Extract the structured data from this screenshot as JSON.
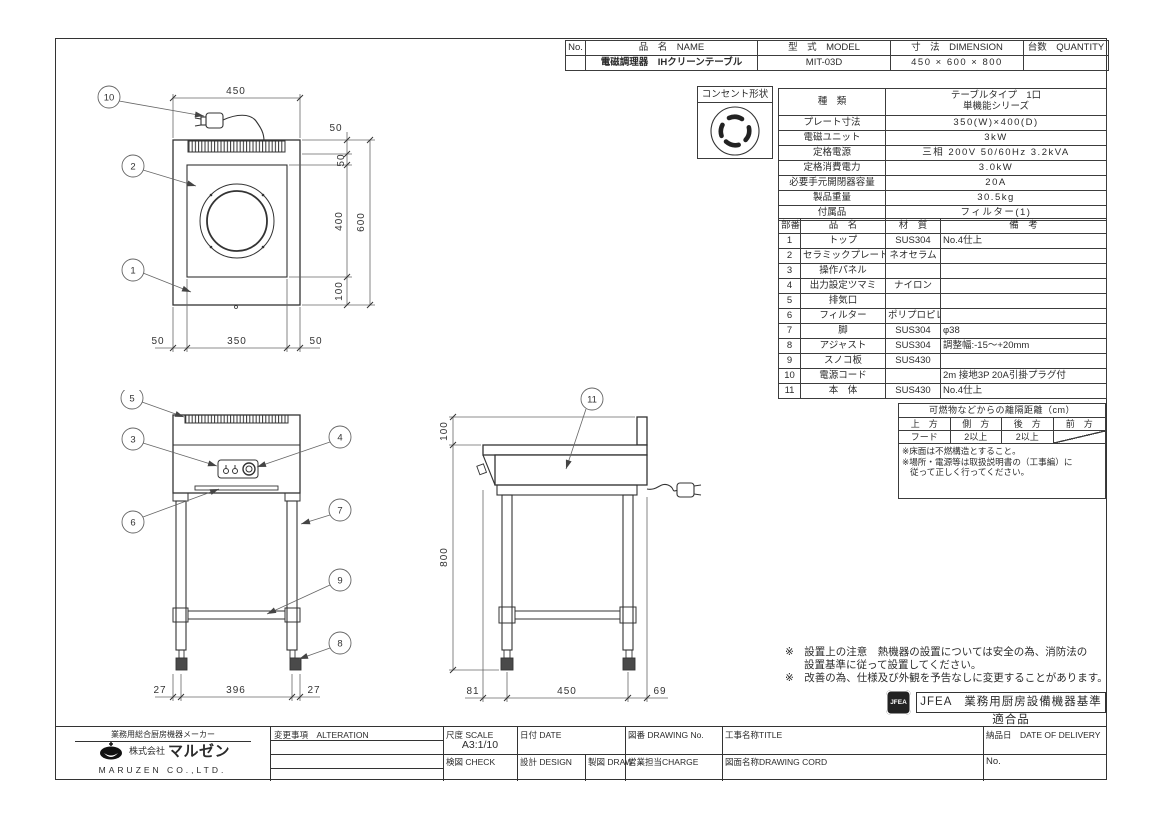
{
  "header_table": {
    "no_label": "No.",
    "name_label": "品　名　NAME",
    "model_label": "型　式　MODEL",
    "dimension_label": "寸　法　DIMENSION",
    "quantity_label": "台数　QUANTITY",
    "no_value": "",
    "name_value": "電磁調理器　IHクリーンテーブル",
    "model_value": "MIT-03D",
    "dimension_value": "450 × 600 × 800",
    "quantity_value": ""
  },
  "outlet": {
    "label": "コンセント形状"
  },
  "spec_table": {
    "rows": [
      {
        "label": "種　類",
        "value": "テーブルタイプ　1口\n単機能シリーズ"
      },
      {
        "label": "プレート寸法",
        "value": "350(W)×400(D)"
      },
      {
        "label": "電磁ユニット",
        "value": "3kW"
      },
      {
        "label": "定格電源",
        "value": "三相 200V 50/60Hz 3.2kVA"
      },
      {
        "label": "定格消費電力",
        "value": "3.0kW"
      },
      {
        "label": "必要手元開閉器容量",
        "value": "20A"
      },
      {
        "label": "製品重量",
        "value": "30.5kg"
      },
      {
        "label": "付属品",
        "value": "フィルター(1)"
      }
    ]
  },
  "parts_table": {
    "headers": [
      "部番",
      "品　名",
      "材　質",
      "備　考"
    ],
    "rows": [
      [
        "1",
        "トップ",
        "SUS304",
        "No.4仕上"
      ],
      [
        "2",
        "セラミックプレート",
        "ネオセラム",
        ""
      ],
      [
        "3",
        "操作パネル",
        "",
        ""
      ],
      [
        "4",
        "出力設定ツマミ",
        "ナイロン",
        ""
      ],
      [
        "5",
        "排気口",
        "",
        ""
      ],
      [
        "6",
        "フィルター",
        "ポリプロピレン",
        ""
      ],
      [
        "7",
        "脚",
        "SUS304",
        "φ38"
      ],
      [
        "8",
        "アジャスト",
        "SUS304",
        "調整幅:-15〜+20mm"
      ],
      [
        "9",
        "スノコ板",
        "SUS430",
        ""
      ],
      [
        "10",
        "電源コード",
        "",
        "2m 接地3P 20A引掛プラグ付"
      ],
      [
        "11",
        "本　体",
        "SUS430",
        "No.4仕上"
      ]
    ]
  },
  "clearance": {
    "title": "可燃物などからの離隔距離（cm）",
    "headers": [
      "上　方",
      "側　方",
      "後　方",
      "前　方"
    ],
    "values": [
      "フード",
      "2以上",
      "2以上",
      ""
    ],
    "note1": "※床面は不燃構造とすること。",
    "note2": "※場所・電源等は取扱説明書の（工事編）に",
    "note3": "従って正しく行ってください。"
  },
  "remarks": {
    "line1": "※　設置上の注意　熱機器の設置については安全の為、消防法の",
    "line2": "設置基準に従って設置してください。",
    "line3": "※　改善の為、仕様及び外観を予告なしに変更することがあります。"
  },
  "jfea": {
    "logo": "JFEA",
    "label": "JFEA　業務用厨房設備機器基準適合品"
  },
  "titleblock": {
    "maker_tagline": "業務用総合厨房機器メーカー",
    "company_prefix": "株式会社",
    "company_name": "マルゼン",
    "company_en": "MARUZEN CO.,LTD.",
    "alteration_label": "変更事項　ALTERATION",
    "scale_label": "尺度 SCALE",
    "scale_value": "A3:1/10",
    "date_label": "日付 DATE",
    "drawing_no_label": "図番 DRAWING No.",
    "title_label": "工事名称TITLE",
    "delivery_label": "納品日　DATE OF DELIVERY",
    "check_label": "検図 CHECK",
    "design_label": "設計 DESIGN",
    "draw_label": "製図 DRAW",
    "charge_label": "営業担当CHARGE",
    "drawing_cord_label": "図面名称DRAWING CORD",
    "no_label": "No."
  },
  "drawing": {
    "plan": {
      "c10": "10",
      "c2": "2",
      "c1": "1",
      "top": "450",
      "r50a": "50",
      "r50b": "50",
      "r400": "400",
      "r100": "100",
      "r600": "600",
      "b50l": "50",
      "b350": "350",
      "b50r": "50"
    },
    "front": {
      "c5": "5",
      "c3": "3",
      "c4": "4",
      "c6": "6",
      "c7": "7",
      "c9": "9",
      "c8": "8",
      "b27l": "27",
      "b396": "396",
      "b27r": "27"
    },
    "side": {
      "c11": "11",
      "h100": "100",
      "h800": "800",
      "b81": "81",
      "b450": "450",
      "b69": "69"
    }
  }
}
